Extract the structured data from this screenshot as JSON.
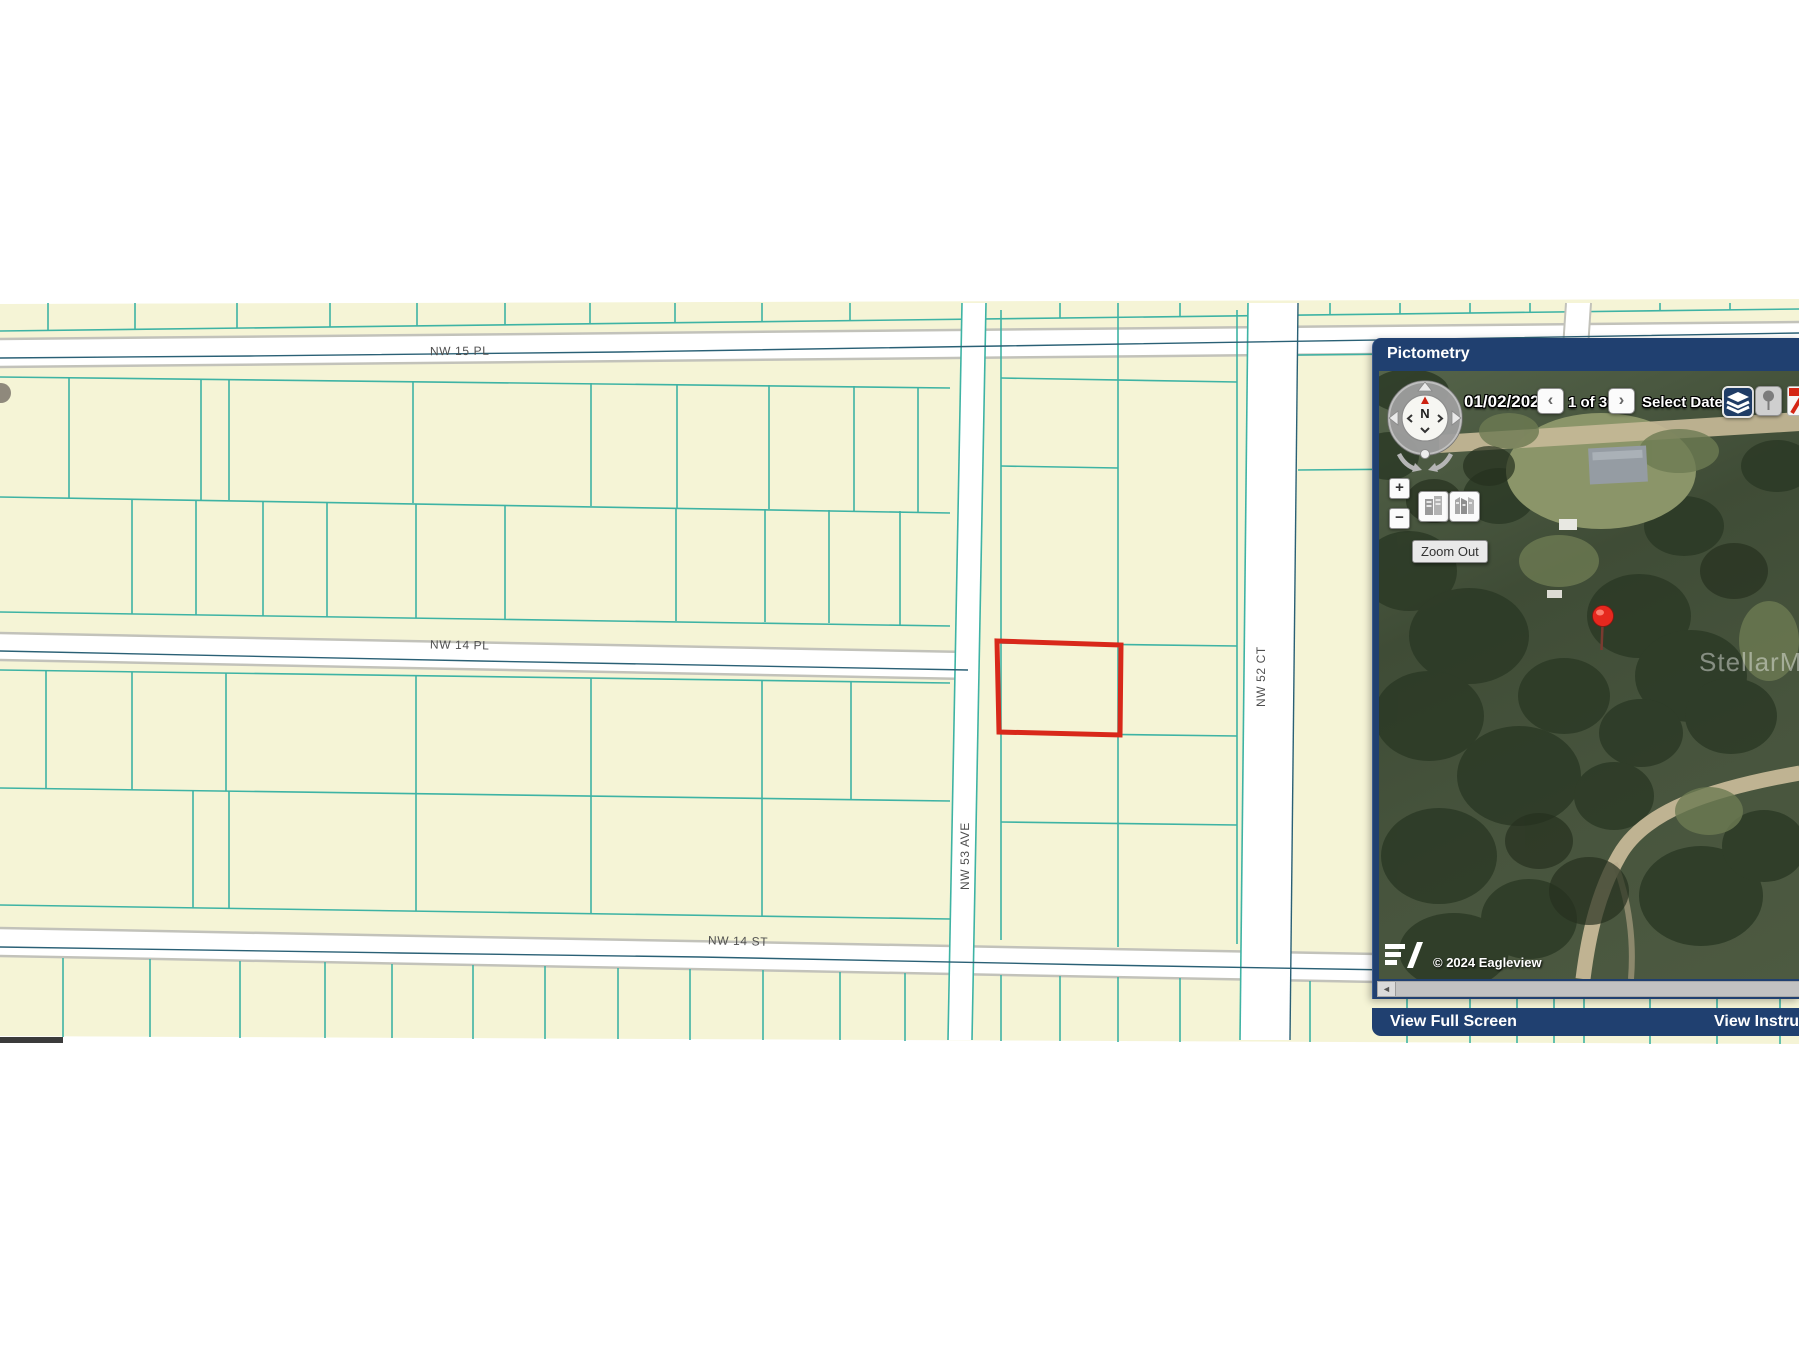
{
  "map": {
    "streets": [
      {
        "label": "NW 15 PL"
      },
      {
        "label": "NW 14 PL"
      },
      {
        "label": "NW 14 ST"
      },
      {
        "label": "NW 53 AVE"
      },
      {
        "label": "NW 52 CT"
      }
    ],
    "colors": {
      "parcel_fill": "#f5f4d6",
      "parcel_line": "#3eb3a4",
      "street_fill": "#ffffff",
      "street_border": "#c2c2ba",
      "street_centerline": "#2a6075",
      "highlight_parcel": "#d8281a",
      "label_text": "#4f4f4f"
    }
  },
  "pictometry": {
    "title": "Pictometry",
    "toolbar": {
      "date": "01/02/2024",
      "prev": "‹",
      "counter": "1 of 30",
      "next": "›",
      "select_date": "Select Date",
      "caret": "▾"
    },
    "controls": {
      "zoom_in": "+",
      "zoom_out": "−",
      "tooltip": "Zoom Out",
      "scrollbar_left": "◄"
    },
    "image": {
      "watermark": "StellarMLS",
      "copyright": "© 2024 Eagleview"
    },
    "footer": {
      "view_full_screen": "View Full Screen",
      "view_instructions": "View Instruc"
    }
  }
}
